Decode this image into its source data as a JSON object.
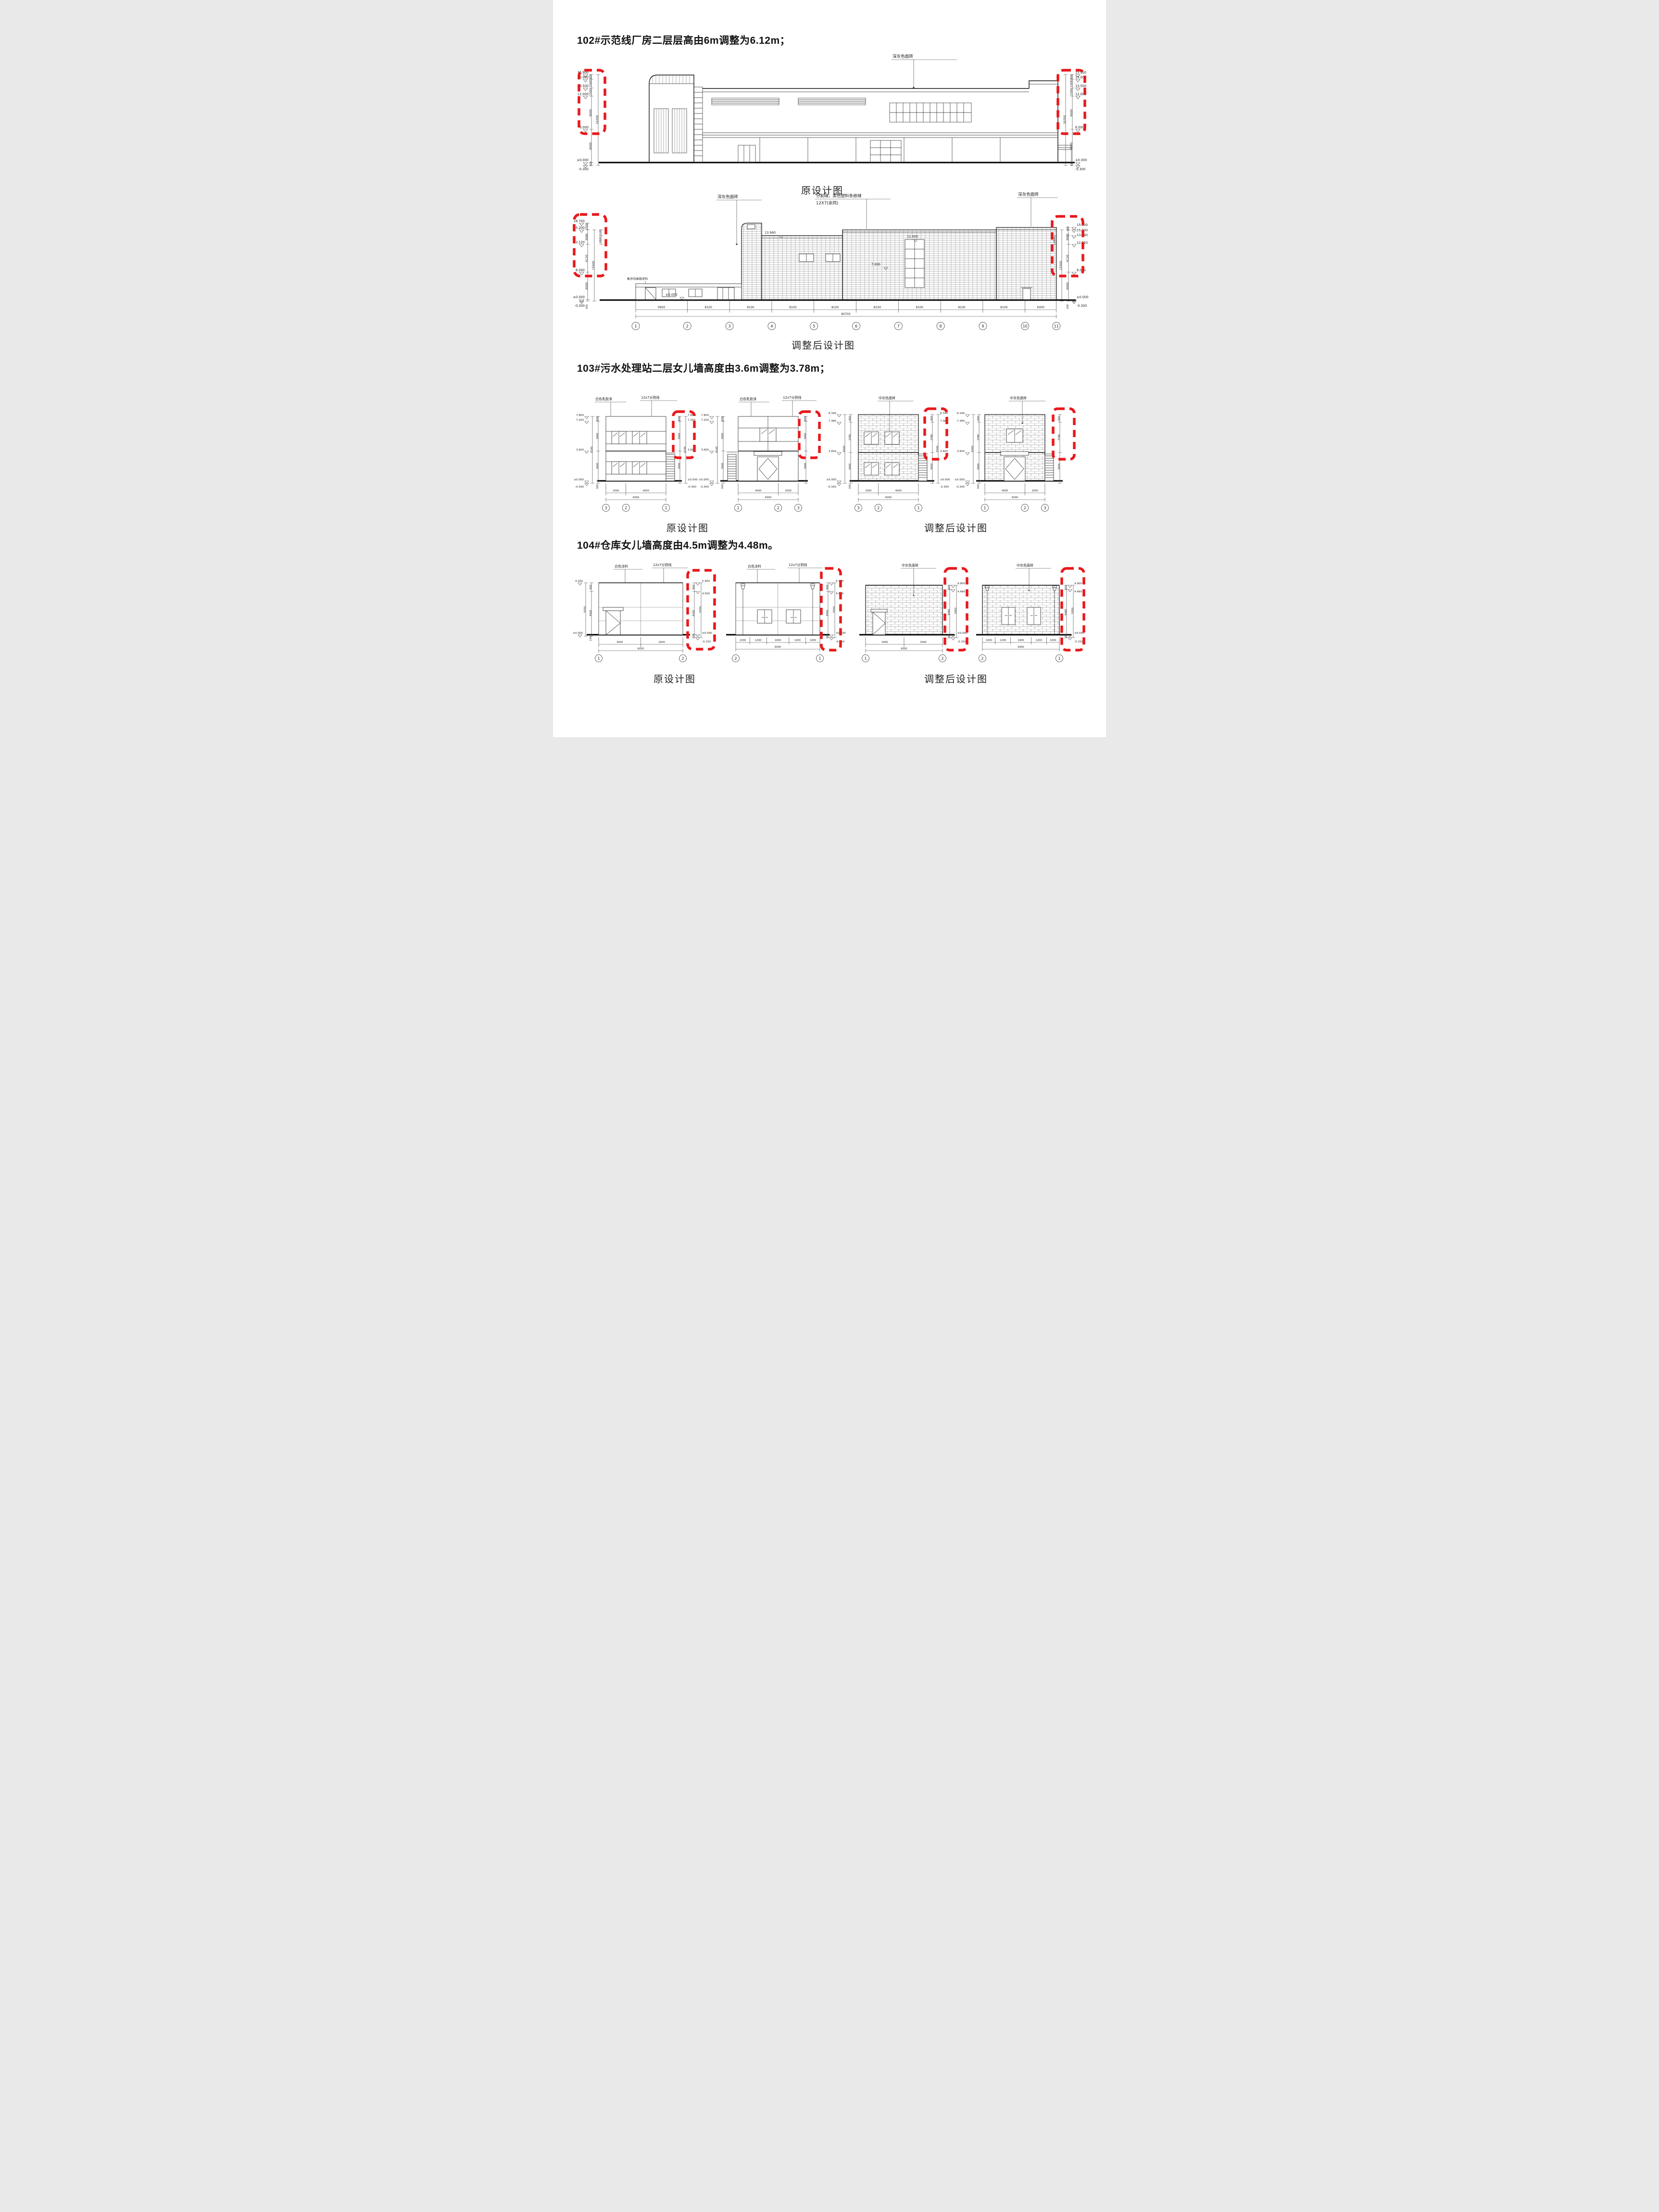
{
  "colors": {
    "highlight_red": "#e8191c",
    "line_black": "#1a1a1a",
    "hatch_gray": "#8a8a8a"
  },
  "s102": {
    "title": "102#示范线厂房二层层高由6m调整为6.12m；",
    "original": {
      "caption": "原设计图",
      "note_facade": "深灰色面砖",
      "levels": [
        "15.900",
        "15.000",
        "13.500",
        "12.000",
        "6.000",
        "±0.000",
        "-0.300"
      ],
      "dims": [
        "900",
        "1500",
        "1500",
        "6000",
        "16200",
        "6000",
        "300"
      ]
    },
    "adjusted": {
      "caption": "调整后设计图",
      "note_left": "深灰色面砖",
      "note_joint_1": "分割缝，黑色塑料条嵌缝",
      "note_joint_2": "12X7(余同)",
      "note_right": "深灰色面砖",
      "note_annex": "象牙白高级涂料",
      "levels_left": [
        "16.700",
        "15.200",
        "12.120",
        "6.000",
        "±0.000",
        "-0.300"
      ],
      "dims_left": [
        "1500",
        "3080",
        "1120",
        "1820",
        "900",
        "1100",
        "6120",
        "15500",
        "5100",
        "6000",
        "1700",
        "1200",
        "1000",
        "300"
      ],
      "levels_right": [
        "15.800",
        "15.200",
        "13.940",
        "12.120",
        "6.000",
        "±0.000",
        "-0.300"
      ],
      "dims_right": [
        "600",
        "3080",
        "1820",
        "3320",
        "6120",
        "1800",
        "15500",
        "4200",
        "6000",
        "1800",
        "1000",
        "300"
      ],
      "wall_levels": {
        "a": "13.940",
        "b": "11.000",
        "c": "7.000",
        "d": "±0.000"
      },
      "grid": {
        "dims": [
          "9900",
          "8100",
          "8100",
          "8100",
          "8100",
          "8100",
          "8100",
          "8100",
          "8100",
          "6000"
        ],
        "total": "80700",
        "bubbles": [
          "1",
          "2",
          "3",
          "4",
          "5",
          "6",
          "7",
          "8",
          "9",
          "10",
          "11"
        ]
      }
    }
  },
  "s103": {
    "title": "103#污水处理站二层女儿墙高度由3.6m调整为3.78m；",
    "caption_original": "原设计图",
    "caption_adjusted": "调整后设计图",
    "original": {
      "note_paint": "白色乳胶漆",
      "note_joint": "12x7分割线",
      "levels": [
        "7.800",
        "7.200",
        "3.600",
        "±0.000",
        "-0.300"
      ],
      "dims": [
        "600",
        "3600",
        "8100",
        "3600",
        "300"
      ],
      "v1_grid": {
        "dims": [
          "2000",
          "4000"
        ],
        "total": "6000",
        "bubbles": [
          "3",
          "2",
          "1"
        ]
      },
      "v2_grid": {
        "dims": [
          "4000",
          "2000"
        ],
        "total": "6000",
        "bubbles": [
          "1",
          "2",
          "3"
        ]
      }
    },
    "adjusted": {
      "note_brick": "中灰色面砖",
      "levels": [
        "8.340",
        "7.380",
        "3.600",
        "±0.000",
        "-0.300"
      ],
      "dims": [
        "660",
        "3780",
        "8340",
        "3600",
        "300"
      ],
      "v3_grid": {
        "dims": [
          "2000",
          "4000"
        ],
        "total": "6000",
        "bubbles": [
          "3",
          "2",
          "1"
        ]
      },
      "v4_grid": {
        "dims": [
          "4000",
          "2000"
        ],
        "total": "6000",
        "bubbles": [
          "1",
          "2",
          "3"
        ]
      }
    }
  },
  "s104": {
    "title": "104#仓库女儿墙高度由4.5m调整为4.48m。",
    "caption_original": "原设计图",
    "caption_adjusted": "调整后设计图",
    "original": {
      "note_paint": "白色涂料",
      "note_joint": "12x7分割线",
      "level_left_top": "4.200",
      "level_zero": "±0.000",
      "levels": [
        "5.400",
        "4.500",
        "±0.000",
        "-0.150"
      ],
      "dims": [
        "900",
        "5550",
        "4500",
        "150"
      ],
      "v1_grid": {
        "dims": [
          "3000",
          "3000"
        ],
        "total": "6000",
        "bubbles": [
          "1",
          "2"
        ]
      },
      "v2_grid": {
        "dims": [
          "1000",
          "1200",
          "1600",
          "1200",
          "1000"
        ],
        "total": "6000",
        "bubbles": [
          "2",
          "1"
        ]
      }
    },
    "adjusted": {
      "note_brick": "中灰色面砖",
      "levels": [
        "4.900",
        "4.480",
        "±0.000",
        "-0.150"
      ],
      "dims": [
        "420",
        "5050",
        "4480",
        "150"
      ],
      "v3_grid": {
        "dims": [
          "3000",
          "3000"
        ],
        "total": "6000",
        "bubbles": [
          "1",
          "2"
        ]
      },
      "v4_grid": {
        "dims": [
          "1000",
          "1200",
          "1600",
          "1200",
          "1000"
        ],
        "total": "6000",
        "bubbles": [
          "2",
          "1"
        ]
      }
    }
  }
}
